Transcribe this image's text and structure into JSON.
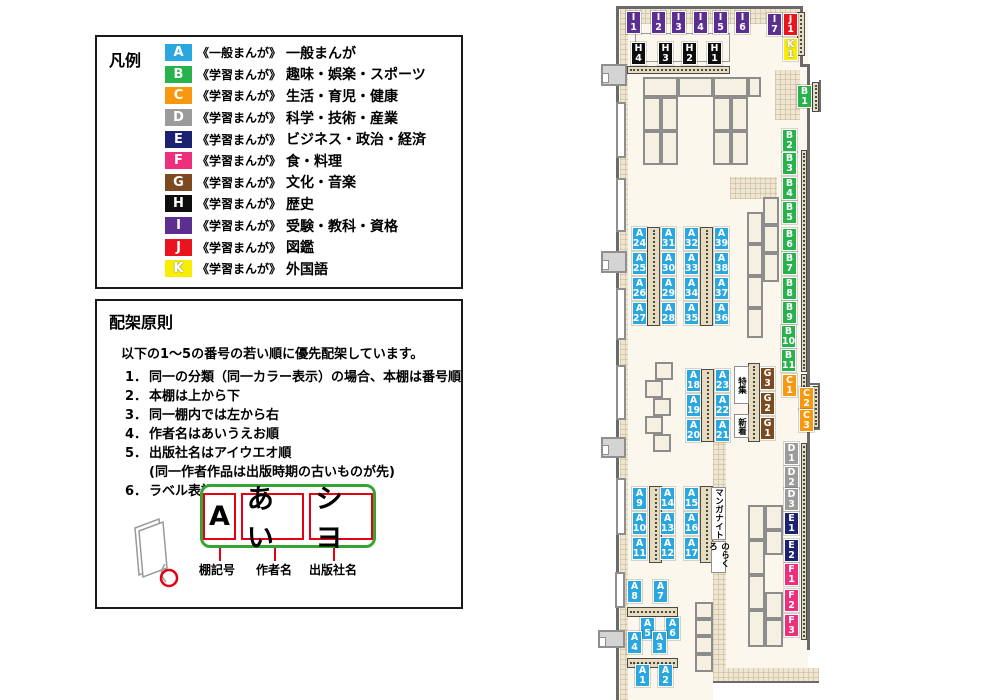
{
  "colors": {
    "A": "#2BA7DF",
    "B": "#28B24B",
    "C": "#F7980F",
    "D": "#9B9B9B",
    "E": "#1B2370",
    "F": "#EE2F7B",
    "G": "#7B4A20",
    "H": "#0D0D0D",
    "I": "#5D2E91",
    "J": "#E9141D",
    "K": "#FAEE00"
  },
  "legend": {
    "title": "凡例",
    "items": [
      {
        "code": "A",
        "type": "《一般まんが》",
        "category": "一般まんが"
      },
      {
        "code": "B",
        "type": "《学習まんが》",
        "category": "趣味・娯楽・スポーツ"
      },
      {
        "code": "C",
        "type": "《学習まんが》",
        "category": "生活・育児・健康"
      },
      {
        "code": "D",
        "type": "《学習まんが》",
        "category": "科学・技術・産業"
      },
      {
        "code": "E",
        "type": "《学習まんが》",
        "category": "ビジネス・政治・経済"
      },
      {
        "code": "F",
        "type": "《学習まんが》",
        "category": "食・料理"
      },
      {
        "code": "G",
        "type": "《学習まんが》",
        "category": "文化・音楽"
      },
      {
        "code": "H",
        "type": "《学習まんが》",
        "category": "歴史"
      },
      {
        "code": "I",
        "type": "《学習まんが》",
        "category": "受験・教科・資格"
      },
      {
        "code": "J",
        "type": "《学習まんが》",
        "category": "図鑑"
      },
      {
        "code": "K",
        "type": "《学習まんが》",
        "category": "外国語"
      }
    ]
  },
  "principles": {
    "title": "配架原則",
    "intro": "以下の1～5の番号の若い順に優先配架しています。",
    "rules": [
      {
        "num": "1．",
        "text": "同一の分類（同一カラー表示）の場合、本棚は番号順"
      },
      {
        "num": "2．",
        "text": "本棚は上から下"
      },
      {
        "num": "3．",
        "text": "同一棚内では左から右"
      },
      {
        "num": "4．",
        "text": "作者名はあいうえお順"
      },
      {
        "num": "5．",
        "text": "出版社名はアイウエオ順",
        "sub": "(同一作者作品は出版時期の古いものが先)"
      },
      {
        "num": "6．",
        "text": "ラベル表記は下図の通り"
      }
    ],
    "label_example": {
      "boxes": [
        "A",
        "あい",
        "シヨ"
      ],
      "captions": [
        "棚記号",
        "作者名",
        "出版社名"
      ]
    }
  },
  "map": {
    "floors": [
      [
        620,
        9,
        188,
        674
      ],
      [
        620,
        683,
        93,
        17
      ],
      [
        808,
        383,
        12,
        47
      ]
    ],
    "hatches": [
      [
        620,
        9,
        182,
        15
      ],
      [
        775,
        70,
        25,
        50
      ],
      [
        620,
        24,
        8,
        676
      ],
      [
        713,
        440,
        13,
        230
      ],
      [
        713,
        668,
        106,
        15
      ],
      [
        730,
        177,
        47,
        22
      ]
    ],
    "walls": [
      [
        616,
        6,
        3,
        694
      ],
      [
        617,
        6,
        186,
        3
      ],
      [
        800,
        6,
        3,
        60
      ],
      [
        800,
        64,
        10,
        3
      ],
      [
        807,
        64,
        3,
        586
      ],
      [
        713,
        681,
        106,
        2
      ],
      [
        808,
        383,
        12,
        2
      ],
      [
        818,
        383,
        2,
        47
      ],
      [
        808,
        428,
        12,
        2
      ],
      [
        819,
        80,
        2,
        32
      ]
    ],
    "outlines": [
      [
        635,
        33,
        95,
        29
      ]
    ],
    "shelves": [
      {
        "o": "h",
        "r": [
          627,
          66,
          103,
          8
        ]
      },
      {
        "o": "v",
        "r": [
          797,
          12,
          8,
          44
        ]
      },
      {
        "o": "v",
        "r": [
          812,
          82,
          7,
          30
        ]
      },
      {
        "o": "v",
        "r": [
          801,
          150,
          6,
          222
        ]
      },
      {
        "o": "v",
        "r": [
          801,
          374,
          6,
          20
        ]
      },
      {
        "o": "v",
        "r": [
          813,
          386,
          6,
          42
        ]
      },
      {
        "o": "v",
        "r": [
          801,
          443,
          6,
          197
        ]
      },
      {
        "o": "v",
        "r": [
          647,
          227,
          13,
          99
        ]
      },
      {
        "o": "v",
        "r": [
          700,
          227,
          13,
          99
        ]
      },
      {
        "o": "v",
        "r": [
          701,
          369,
          13,
          73
        ]
      },
      {
        "o": "v",
        "r": [
          649,
          486,
          13,
          77
        ]
      },
      {
        "o": "v",
        "r": [
          700,
          486,
          13,
          77
        ]
      },
      {
        "o": "v",
        "r": [
          748,
          363,
          12,
          79
        ]
      },
      {
        "o": "h",
        "r": [
          627,
          607,
          51,
          10
        ]
      },
      {
        "o": "h",
        "r": [
          627,
          658,
          51,
          10
        ]
      }
    ],
    "tables": [
      [
        643,
        77,
        35,
        20
      ],
      [
        678,
        77,
        35,
        20
      ],
      [
        713,
        77,
        35,
        20
      ],
      [
        748,
        77,
        13,
        20
      ],
      [
        643,
        97,
        18,
        34
      ],
      [
        661,
        97,
        17,
        34
      ],
      [
        643,
        131,
        18,
        34
      ],
      [
        661,
        131,
        17,
        34
      ],
      [
        713,
        97,
        18,
        34
      ],
      [
        731,
        97,
        17,
        34
      ],
      [
        713,
        131,
        18,
        34
      ],
      [
        731,
        131,
        17,
        34
      ],
      [
        747,
        212,
        16,
        32
      ],
      [
        747,
        244,
        16,
        32
      ],
      [
        747,
        276,
        16,
        32
      ],
      [
        747,
        308,
        16,
        30
      ],
      [
        763,
        197,
        16,
        28
      ],
      [
        763,
        225,
        16,
        28
      ],
      [
        763,
        253,
        16,
        29
      ],
      [
        655,
        362,
        18,
        18
      ],
      [
        645,
        380,
        18,
        18
      ],
      [
        653,
        398,
        18,
        18
      ],
      [
        645,
        416,
        18,
        18
      ],
      [
        653,
        434,
        18,
        18
      ],
      [
        748,
        505,
        17,
        35
      ],
      [
        748,
        540,
        17,
        35
      ],
      [
        748,
        575,
        17,
        35
      ],
      [
        748,
        610,
        17,
        37
      ],
      [
        765,
        505,
        18,
        25
      ],
      [
        765,
        530,
        18,
        25
      ],
      [
        765,
        592,
        18,
        27
      ],
      [
        765,
        619,
        18,
        28
      ],
      [
        695,
        602,
        18,
        17
      ],
      [
        695,
        619,
        18,
        17
      ],
      [
        695,
        636,
        18,
        18
      ],
      [
        695,
        654,
        18,
        18
      ]
    ],
    "windows": [
      [
        616,
        102,
        10,
        56
      ],
      [
        616,
        178,
        10,
        54
      ],
      [
        616,
        288,
        10,
        52
      ],
      [
        616,
        365,
        10,
        55
      ],
      [
        616,
        478,
        10,
        57
      ],
      [
        615,
        572,
        10,
        36
      ]
    ],
    "doors": [
      [
        601,
        64,
        26,
        22
      ],
      [
        601,
        251,
        26,
        22
      ],
      [
        601,
        437,
        25,
        21
      ],
      [
        598,
        630,
        27,
        18
      ]
    ],
    "vboxes": [
      {
        "t": "特集",
        "x": 734,
        "y": 366,
        "w": 15,
        "h": 38
      },
      {
        "t": "新着",
        "x": 734,
        "y": 414,
        "w": 15,
        "h": 24
      },
      {
        "t": "マンガナイト",
        "x": 711,
        "y": 487,
        "w": 15,
        "h": 53
      },
      {
        "t": "のらくろ",
        "x": 711,
        "y": 541,
        "w": 15,
        "h": 32
      }
    ],
    "labels": [
      {
        "c": "I1",
        "x": 626,
        "y": 11
      },
      {
        "c": "I2",
        "x": 651,
        "y": 11
      },
      {
        "c": "I3",
        "x": 671,
        "y": 11
      },
      {
        "c": "I4",
        "x": 693,
        "y": 11
      },
      {
        "c": "I5",
        "x": 713,
        "y": 11
      },
      {
        "c": "I6",
        "x": 735,
        "y": 11
      },
      {
        "c": "I7",
        "x": 767,
        "y": 13
      },
      {
        "c": "J1",
        "x": 783,
        "y": 13
      },
      {
        "c": "K1",
        "x": 783,
        "y": 38
      },
      {
        "c": "H4",
        "x": 631,
        "y": 42
      },
      {
        "c": "H3",
        "x": 658,
        "y": 42
      },
      {
        "c": "H2",
        "x": 682,
        "y": 42
      },
      {
        "c": "H1",
        "x": 707,
        "y": 42
      },
      {
        "c": "B1",
        "x": 797,
        "y": 85
      },
      {
        "c": "B2",
        "x": 782,
        "y": 129
      },
      {
        "c": "B3",
        "x": 782,
        "y": 152
      },
      {
        "c": "B4",
        "x": 782,
        "y": 177
      },
      {
        "c": "B5",
        "x": 782,
        "y": 201
      },
      {
        "c": "B6",
        "x": 782,
        "y": 228
      },
      {
        "c": "B7",
        "x": 782,
        "y": 252
      },
      {
        "c": "B8",
        "x": 782,
        "y": 277
      },
      {
        "c": "B9",
        "x": 782,
        "y": 301
      },
      {
        "c": "B10",
        "x": 781,
        "y": 325
      },
      {
        "c": "B11",
        "x": 781,
        "y": 349
      },
      {
        "c": "C1",
        "x": 782,
        "y": 374
      },
      {
        "c": "C2",
        "x": 799,
        "y": 387
      },
      {
        "c": "C3",
        "x": 799,
        "y": 409
      },
      {
        "c": "D1",
        "x": 784,
        "y": 442
      },
      {
        "c": "D2",
        "x": 784,
        "y": 466
      },
      {
        "c": "D3",
        "x": 784,
        "y": 488
      },
      {
        "c": "E1",
        "x": 784,
        "y": 512
      },
      {
        "c": "E2",
        "x": 784,
        "y": 539
      },
      {
        "c": "F1",
        "x": 784,
        "y": 563
      },
      {
        "c": "F2",
        "x": 784,
        "y": 589
      },
      {
        "c": "F3",
        "x": 784,
        "y": 614
      },
      {
        "c": "G3",
        "x": 760,
        "y": 367
      },
      {
        "c": "G2",
        "x": 760,
        "y": 392
      },
      {
        "c": "G1",
        "x": 760,
        "y": 417
      },
      {
        "c": "A24",
        "x": 632,
        "y": 227
      },
      {
        "c": "A25",
        "x": 632,
        "y": 252
      },
      {
        "c": "A26",
        "x": 632,
        "y": 277
      },
      {
        "c": "A27",
        "x": 632,
        "y": 302
      },
      {
        "c": "A31",
        "x": 661,
        "y": 227
      },
      {
        "c": "A30",
        "x": 661,
        "y": 252
      },
      {
        "c": "A29",
        "x": 661,
        "y": 277
      },
      {
        "c": "A28",
        "x": 661,
        "y": 302
      },
      {
        "c": "A32",
        "x": 684,
        "y": 227
      },
      {
        "c": "A33",
        "x": 684,
        "y": 252
      },
      {
        "c": "A34",
        "x": 684,
        "y": 277
      },
      {
        "c": "A35",
        "x": 684,
        "y": 302
      },
      {
        "c": "A39",
        "x": 714,
        "y": 227
      },
      {
        "c": "A38",
        "x": 714,
        "y": 252
      },
      {
        "c": "A37",
        "x": 714,
        "y": 277
      },
      {
        "c": "A36",
        "x": 714,
        "y": 302
      },
      {
        "c": "A18",
        "x": 686,
        "y": 369
      },
      {
        "c": "A19",
        "x": 686,
        "y": 394
      },
      {
        "c": "A20",
        "x": 686,
        "y": 419
      },
      {
        "c": "A23",
        "x": 715,
        "y": 369
      },
      {
        "c": "A22",
        "x": 715,
        "y": 394
      },
      {
        "c": "A21",
        "x": 715,
        "y": 419
      },
      {
        "c": "A9",
        "x": 632,
        "y": 487
      },
      {
        "c": "A10",
        "x": 632,
        "y": 512
      },
      {
        "c": "A11",
        "x": 632,
        "y": 537
      },
      {
        "c": "A14",
        "x": 660,
        "y": 487
      },
      {
        "c": "A13",
        "x": 660,
        "y": 512
      },
      {
        "c": "A12",
        "x": 660,
        "y": 537
      },
      {
        "c": "A15",
        "x": 684,
        "y": 487
      },
      {
        "c": "A16",
        "x": 684,
        "y": 512
      },
      {
        "c": "A17",
        "x": 684,
        "y": 537
      },
      {
        "c": "A8",
        "x": 627,
        "y": 580
      },
      {
        "c": "A7",
        "x": 653,
        "y": 580
      },
      {
        "c": "A5",
        "x": 640,
        "y": 617
      },
      {
        "c": "A6",
        "x": 665,
        "y": 617
      },
      {
        "c": "A4",
        "x": 627,
        "y": 631
      },
      {
        "c": "A3",
        "x": 652,
        "y": 631
      },
      {
        "c": "A1",
        "x": 635,
        "y": 664
      },
      {
        "c": "A2",
        "x": 658,
        "y": 664
      }
    ]
  }
}
